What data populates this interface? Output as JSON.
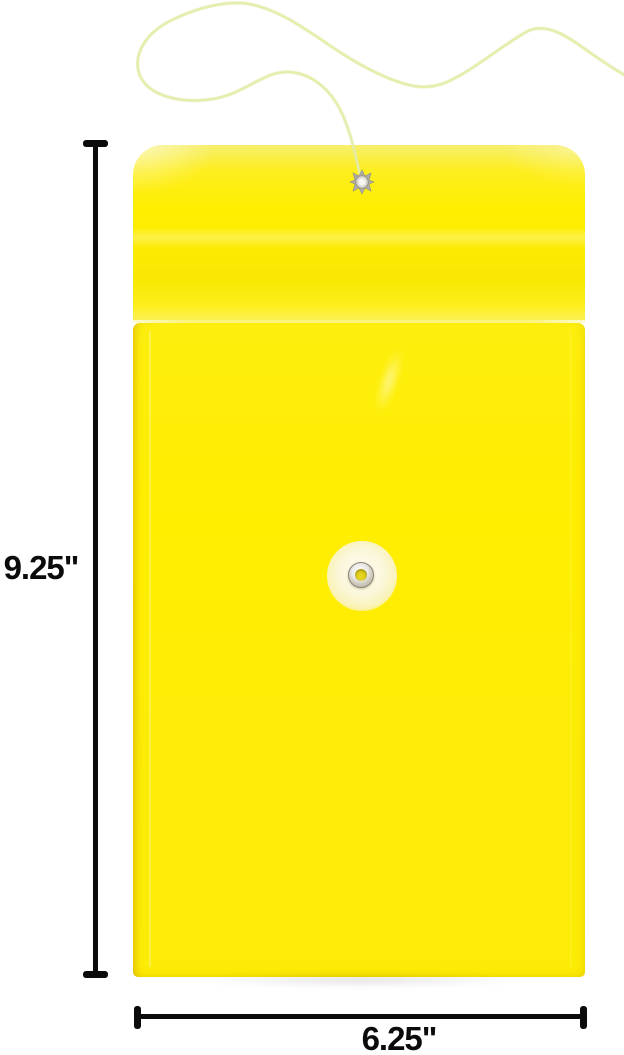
{
  "image": {
    "description": "Bright yellow poly string-tie envelope with looped cord, flap grommet and round tie button, shown with size callouts",
    "colors": {
      "background": "#FFFFFF",
      "envelope_yellow": "#FFEE00",
      "envelope_deep_yellow": "#F8E802",
      "string_cord": "#E7EDAA",
      "button_face": "#FBF7DC",
      "eyelet_metal": "#C0BCB0",
      "dimension_ink": "#0B0B0B"
    }
  },
  "dimensions": {
    "height_label": "9.25\"",
    "width_label": "6.25\""
  }
}
